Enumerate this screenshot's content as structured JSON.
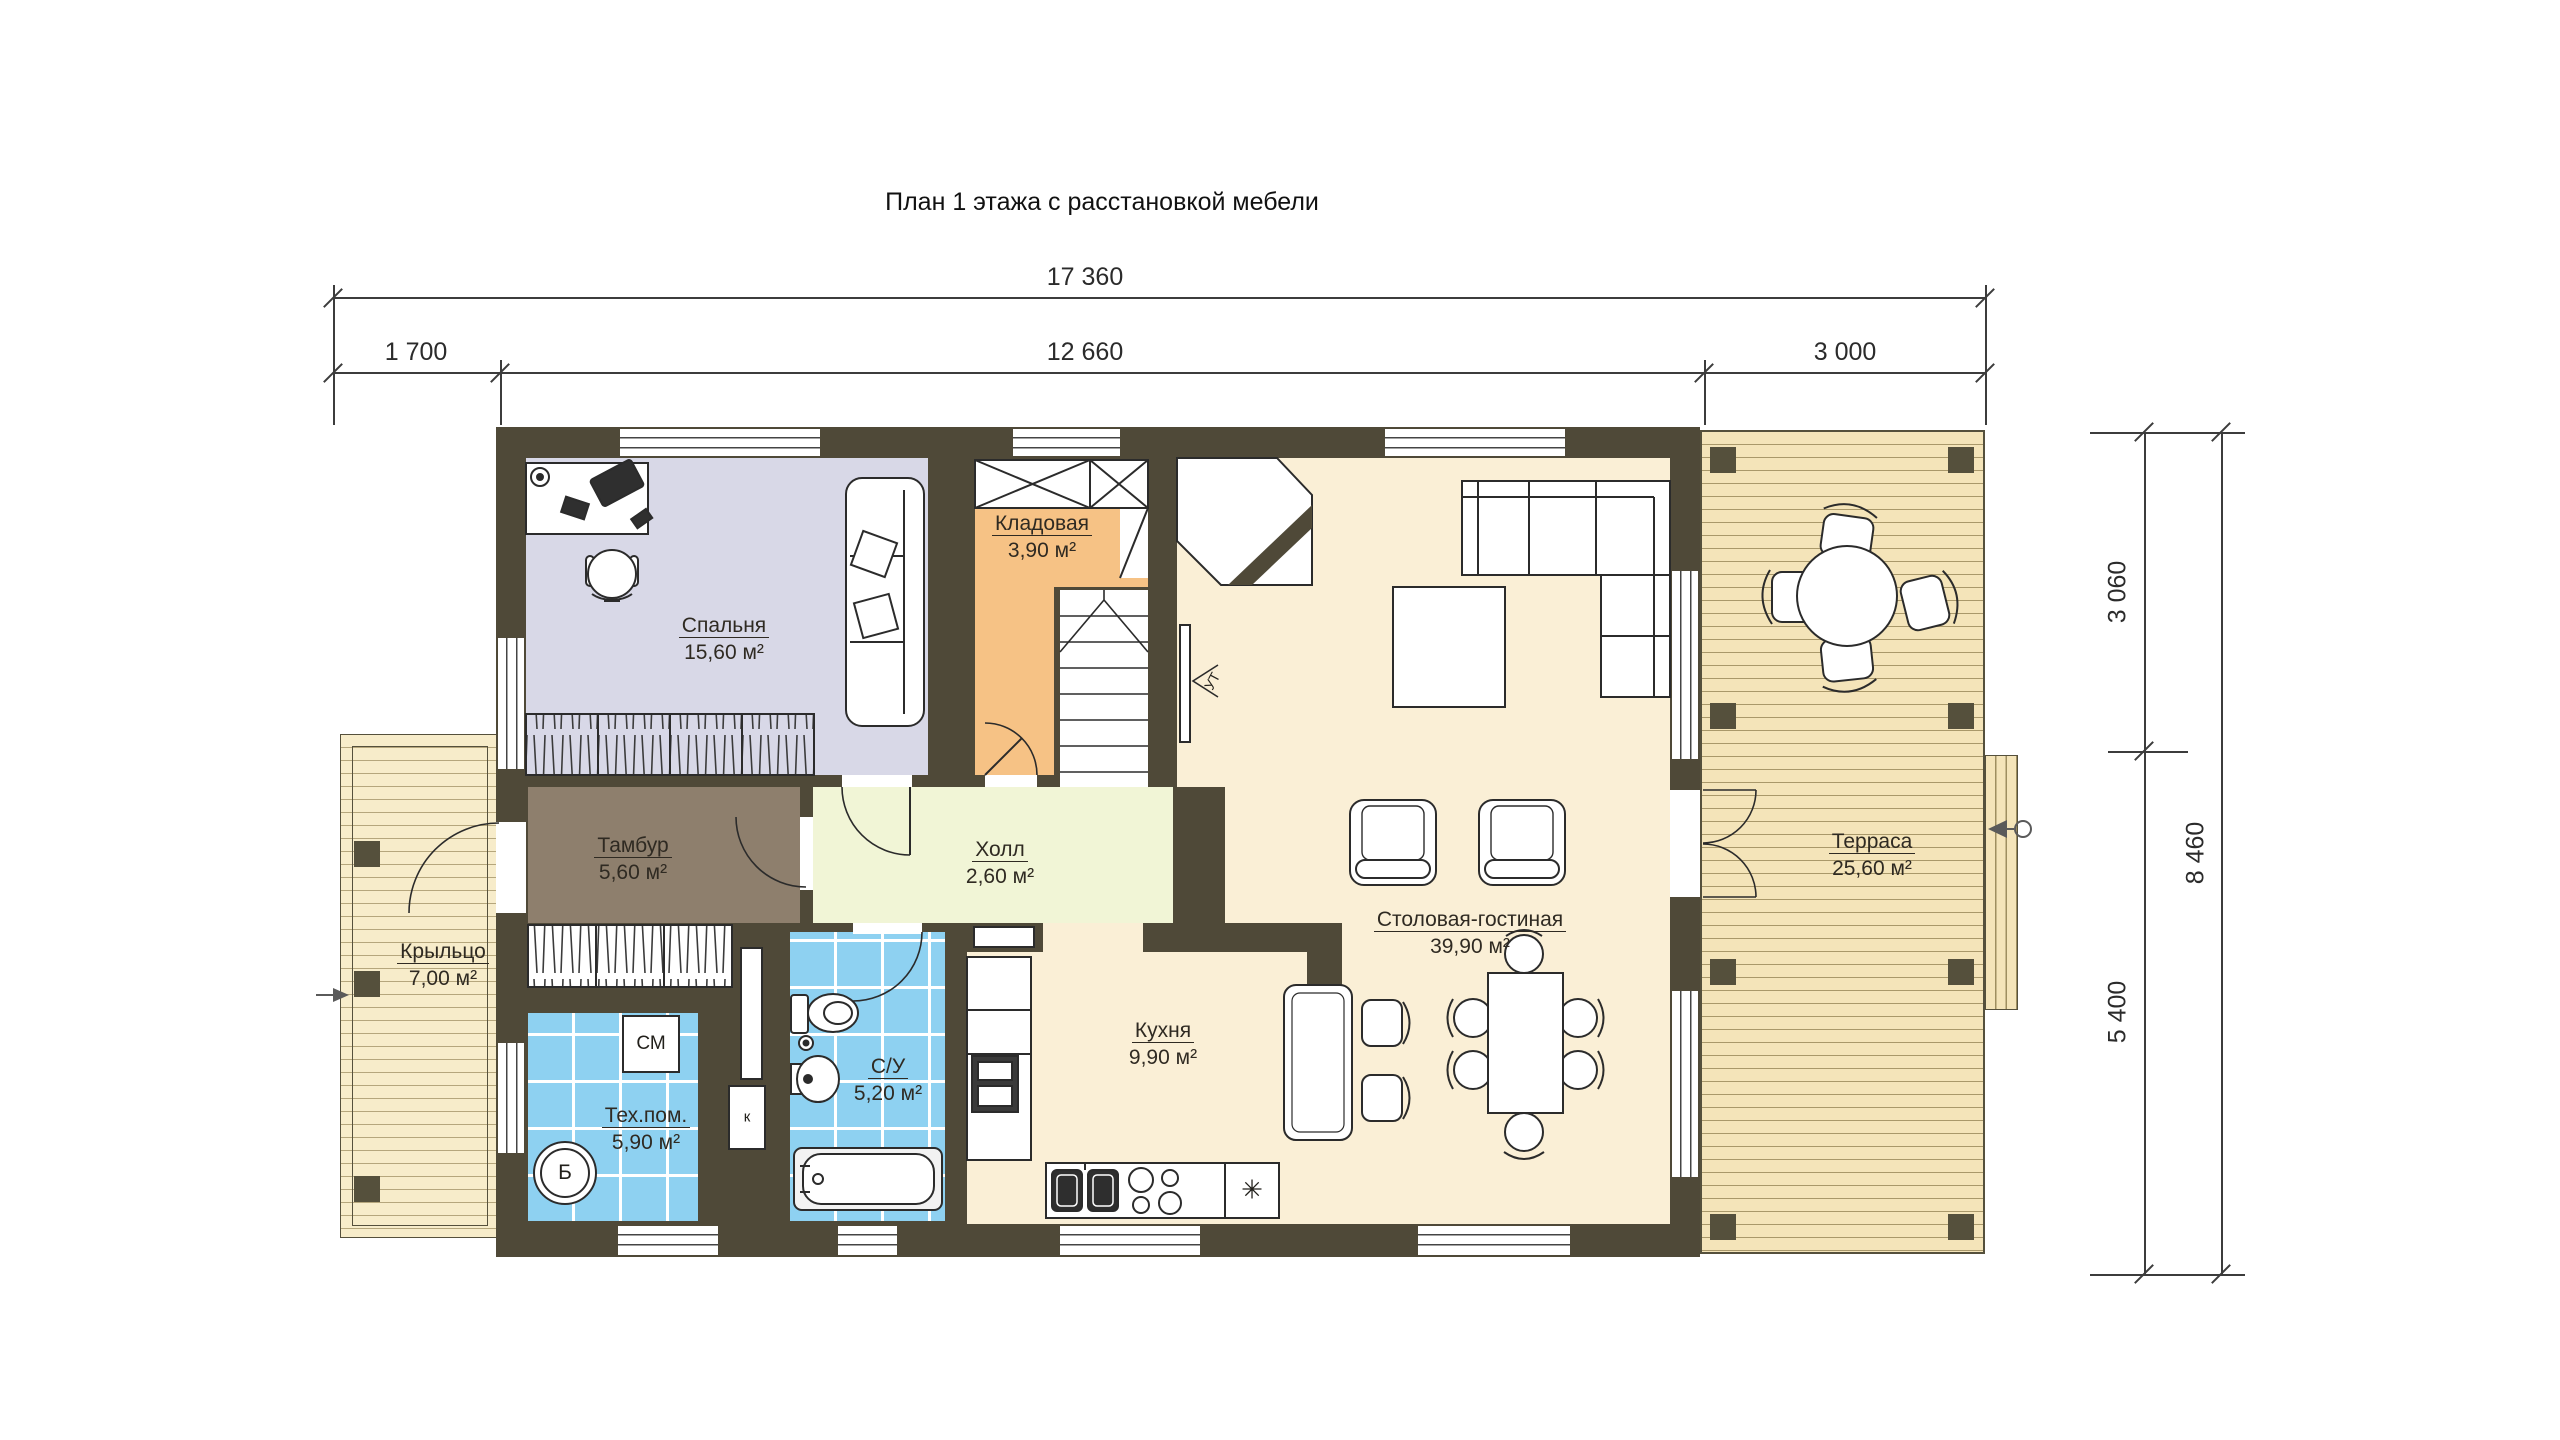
{
  "title": "План 1 этажа с расстановкой мебели",
  "dimensions": {
    "top_total": "17 360",
    "top_left": "1 700",
    "top_middle": "12 660",
    "top_right": "3 000",
    "side_upper": "3 060",
    "side_lower": "5 400",
    "side_total": "8 460"
  },
  "rooms": {
    "bedroom": {
      "name": "Спальня",
      "area": "15,60 м²"
    },
    "storage": {
      "name": "Кладовая",
      "area": "3,90 м²"
    },
    "hall": {
      "name": "Холл",
      "area": "2,60 м²"
    },
    "vestibule": {
      "name": "Тамбур",
      "area": "5,60 м²"
    },
    "porch": {
      "name": "Крыльцо",
      "area": "7,00 м²"
    },
    "utility": {
      "name": "Тех.пом.",
      "area": "5,90 м²"
    },
    "bathroom": {
      "name": "С/У",
      "area": "5,20 м²"
    },
    "kitchen": {
      "name": "Кухня",
      "area": "9,90 м²"
    },
    "living": {
      "name": "Столовая-гостиная",
      "area": "39,90 м²"
    },
    "terrace": {
      "name": "Терраса",
      "area": "25,60 м²"
    }
  },
  "markers": {
    "washing_machine": "СМ",
    "boiler": "Б",
    "duct": "к",
    "tv": "УТ",
    "fridge": "✳"
  },
  "colors": {
    "wall": "#4f4938",
    "bedroom_floor": "#d8d8e7",
    "storage_floor": "#f6c285",
    "hall_floor": "#f1f5d6",
    "vestibule_floor": "#8e7f6d",
    "living_floor": "#faefd6",
    "tile_floor": "#8ed1f1",
    "deck": "#f4e4b9"
  }
}
